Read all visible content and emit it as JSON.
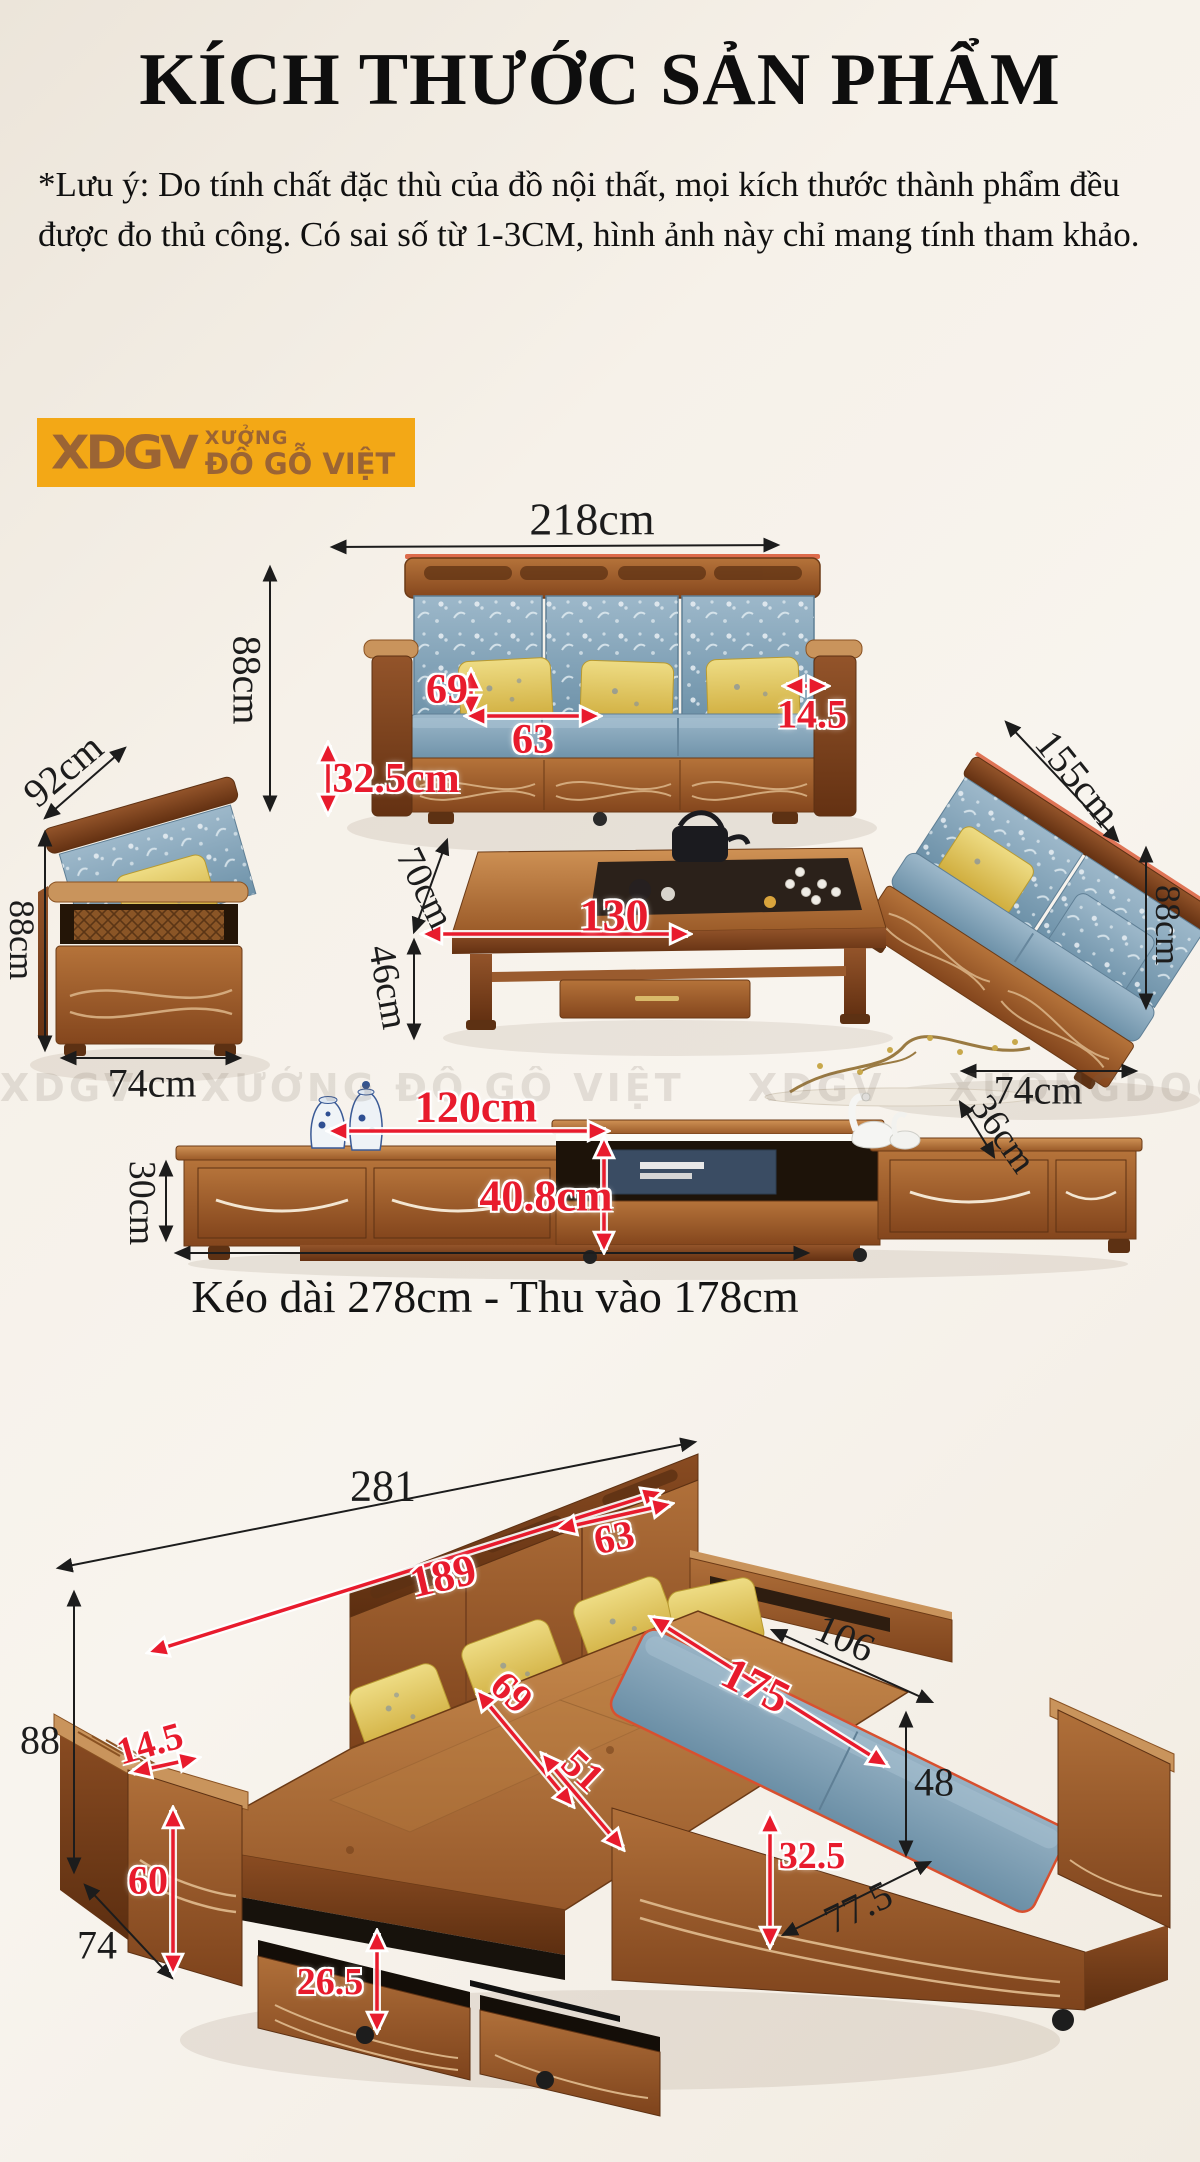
{
  "page": {
    "title": "KÍCH THƯỚC SẢN PHẨM",
    "note": "*Lưu ý: Do tính chất đặc thù của đồ nội thất, mọi kích thước thành phẩm đều được đo thủ công. Có sai số từ 1-3CM, hình ảnh này chỉ mang tính tham khảo.",
    "extension_note": "Kéo dài 278cm - Thu vào 178cm"
  },
  "logo": {
    "abbr": "XDGV",
    "line1": "XƯỞNG",
    "line2": "ĐỒ GỖ VIỆT",
    "bg_color": "#F3A816",
    "text_color": "#9B6434"
  },
  "watermark": {
    "brand": "XDGV",
    "tagline": "XƯỞNG ĐỒ GỖ VIỆT",
    "site": "XUONGDOGOVIET.COM"
  },
  "colors": {
    "dim_black": "#1c1c1c",
    "dim_red": "#E81B2D",
    "background": "#F2EDE5",
    "wood": "#A5642F",
    "cushion_blue": "#7D9FB5",
    "pillow_yellow": "#E2C85D"
  },
  "sofa_set": {
    "sofa_width": "218cm",
    "sofa_height": "88cm",
    "seat_back_height": "69",
    "seat_width": "63",
    "base_height": "32.5cm",
    "armrest_width": "14.5",
    "loveseat_length": "155cm",
    "loveseat_height": "88cm",
    "loveseat_depth": "74cm",
    "armchair_diag": "92cm",
    "armchair_height": "88cm",
    "armchair_depth": "74cm",
    "table_length": "130",
    "table_depth": "70cm",
    "table_height": "46cm",
    "tv_mid_width": "120cm",
    "tv_mid_height": "40.8cm",
    "tv_height": "30cm",
    "tv_depth": "36cm"
  },
  "corner_sofa": {
    "total_width": "281",
    "back_width": "189",
    "corner_width": "63",
    "height": "88",
    "armrest_top": "14.5",
    "armrest_height": "60",
    "depth": "74",
    "drawer_height": "26.5",
    "seat_depth": "69",
    "seat_width": "51",
    "chaise_depth": "106",
    "chaise_length": "175",
    "chaise_height": "48",
    "base_height": "32.5",
    "bottom_diag": "77.5"
  }
}
